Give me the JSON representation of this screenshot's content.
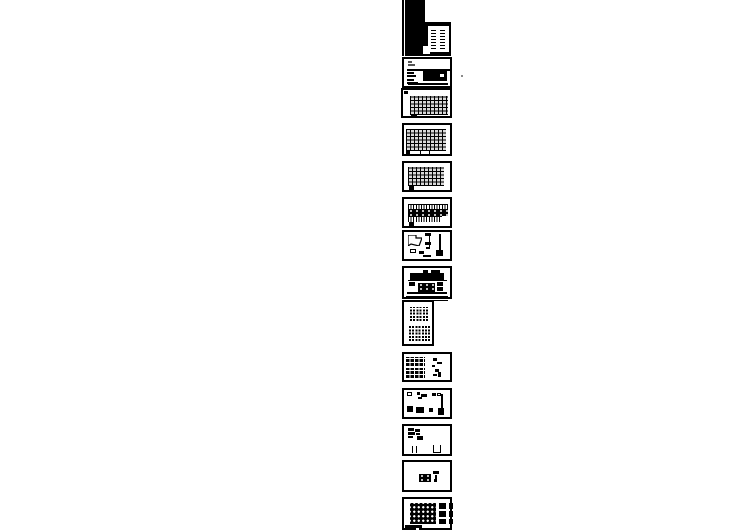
{
  "canvas": {
    "width": 749,
    "height": 530,
    "background": "#ffffff"
  },
  "document": {
    "kind": "cad-sheet-preview-strip",
    "sheet_count": 14
  },
  "colors": {
    "paper": "#ffffff",
    "ink": "#000000",
    "muted_mark": "#555555",
    "stray_dot": "#8a8a8a"
  },
  "sheets": [
    {
      "name": "sheet-01-cover",
      "x": 402,
      "y": 0,
      "w": 50,
      "h": 56,
      "frameless": true,
      "shapes": [
        {
          "t": "fill",
          "n": "left-edge-line",
          "x": 0,
          "y": 0,
          "w": 1.5,
          "h": 56
        },
        {
          "t": "fill",
          "n": "cover-black-mass",
          "x": 3,
          "y": 0,
          "w": 20,
          "h": 56
        },
        {
          "t": "fill",
          "n": "cover-body",
          "x": 3,
          "y": 22,
          "w": 46,
          "h": 34
        },
        {
          "t": "white",
          "n": "cover-panel",
          "x": 26,
          "y": 26,
          "w": 21,
          "h": 26
        },
        {
          "t": "white",
          "n": "cover-panel-step",
          "x": 21,
          "y": 46,
          "w": 7,
          "h": 8
        },
        {
          "t": "dashcol",
          "n": "drawing-list-column",
          "x": 29,
          "y": 28,
          "w": 5,
          "h": 21
        },
        {
          "t": "dashcol",
          "n": "drawing-list-column",
          "x": 38,
          "y": 28,
          "w": 5,
          "h": 21
        }
      ]
    },
    {
      "name": "sheet-02-notes",
      "x": 402,
      "y": 57,
      "w": 50,
      "h": 31,
      "shapes": [
        {
          "t": "gray",
          "n": "title-mark",
          "x": 4,
          "y": 2,
          "w": 4,
          "h": 2
        },
        {
          "t": "gray",
          "n": "title-mark",
          "x": 4,
          "y": 4.5,
          "w": 7,
          "h": 2
        },
        {
          "t": "hline",
          "n": "divider-line",
          "x": 3,
          "y": 10,
          "w": 44,
          "h": 1.5
        },
        {
          "t": "fill",
          "n": "text-bar",
          "x": 3,
          "y": 12.5,
          "w": 7,
          "h": 2
        },
        {
          "t": "fill",
          "n": "text-bar",
          "x": 3,
          "y": 16,
          "w": 9,
          "h": 2
        },
        {
          "t": "fill",
          "n": "text-bar",
          "x": 3,
          "y": 19.5,
          "w": 7,
          "h": 2
        },
        {
          "t": "fill",
          "n": "text-bar",
          "x": 3,
          "y": 22.5,
          "w": 11,
          "h": 2
        },
        {
          "t": "fill",
          "n": "table-block",
          "x": 19,
          "y": 12,
          "w": 24,
          "h": 10
        },
        {
          "t": "white",
          "n": "table-gap",
          "x": 36,
          "y": 15,
          "w": 4,
          "h": 3
        },
        {
          "t": "fill",
          "n": "bottom-bar",
          "x": 4,
          "y": 24,
          "w": 40,
          "h": 2
        }
      ]
    },
    {
      "name": "sheet-03-framing-plan",
      "x": 401,
      "y": 88,
      "w": 51,
      "h": 30,
      "shapes": [
        {
          "t": "fill",
          "n": "corner-mark",
          "x": 1,
          "y": 1,
          "w": 4,
          "h": 3
        },
        {
          "t": "hatch",
          "n": "framing-grid",
          "x": 7,
          "y": 6,
          "w": 38,
          "h": 19
        },
        {
          "t": "fill",
          "n": "tab-mark",
          "x": 8,
          "y": 25,
          "w": 6,
          "h": 3
        }
      ]
    },
    {
      "name": "sheet-04-framing-plan",
      "x": 402,
      "y": 123,
      "w": 50,
      "h": 33,
      "shapes": [
        {
          "t": "hatch",
          "n": "framing-grid",
          "x": 2,
          "y": 4,
          "w": 40,
          "h": 22
        },
        {
          "t": "outline",
          "n": "note-box",
          "x": 16,
          "y": 25,
          "w": 10,
          "h": 5
        },
        {
          "t": "fill",
          "n": "tab-mark",
          "x": 2,
          "y": 25,
          "w": 4,
          "h": 4
        }
      ]
    },
    {
      "name": "sheet-05-framing-plan",
      "x": 402,
      "y": 161,
      "w": 50,
      "h": 31,
      "shapes": [
        {
          "t": "hatch",
          "n": "framing-grid",
          "x": 4,
          "y": 4,
          "w": 36,
          "h": 19
        },
        {
          "t": "fill",
          "n": "tab-mark",
          "x": 5,
          "y": 23,
          "w": 5,
          "h": 4
        }
      ]
    },
    {
      "name": "sheet-06-framing-plan",
      "x": 402,
      "y": 197,
      "w": 50,
      "h": 31,
      "shapes": [
        {
          "t": "vticks",
          "n": "tick-row",
          "x": 4,
          "y": 5,
          "w": 40,
          "h": 5
        },
        {
          "t": "band",
          "n": "dense-band",
          "x": 4,
          "y": 10,
          "w": 40,
          "h": 7
        },
        {
          "t": "vticks",
          "n": "tick-row",
          "x": 4,
          "y": 17,
          "w": 34,
          "h": 5
        },
        {
          "t": "fill",
          "n": "tab-mark",
          "x": 5,
          "y": 23,
          "w": 5,
          "h": 4
        }
      ]
    },
    {
      "name": "sheet-07-details",
      "x": 402,
      "y": 230,
      "w": 50,
      "h": 31,
      "shapes": [
        {
          "t": "poly",
          "n": "detail-outline",
          "x": 4,
          "y": 3,
          "w": 14,
          "h": 11,
          "pts": "0,0 8,0 8,3 14,3 11,11 3,9 0,11"
        },
        {
          "t": "fill",
          "n": "detail-mark",
          "x": 21,
          "y": 1,
          "w": 6,
          "h": 3
        },
        {
          "t": "vline",
          "n": "detail-line",
          "x": 25,
          "y": 4,
          "w": 1.2,
          "h": 12
        },
        {
          "t": "fill",
          "n": "detail-mark",
          "x": 21,
          "y": 10,
          "w": 6,
          "h": 3
        },
        {
          "t": "fill",
          "n": "detail-mark",
          "x": 22,
          "y": 15,
          "w": 4,
          "h": 2
        },
        {
          "t": "vline",
          "n": "detail-line",
          "x": 35,
          "y": 2,
          "w": 1.5,
          "h": 22
        },
        {
          "t": "fill",
          "n": "detail-blob",
          "x": 32,
          "y": 18,
          "w": 7,
          "h": 6
        },
        {
          "t": "outline",
          "n": "small-box",
          "x": 6,
          "y": 17,
          "w": 6,
          "h": 4
        },
        {
          "t": "fill",
          "n": "detail-mark",
          "x": 15,
          "y": 19,
          "w": 5,
          "h": 3
        },
        {
          "t": "fill",
          "n": "detail-mark",
          "x": 19,
          "y": 23,
          "w": 8,
          "h": 2
        }
      ]
    },
    {
      "name": "sheet-08-details",
      "x": 402,
      "y": 266,
      "w": 50,
      "h": 33,
      "shapes": [
        {
          "t": "fill",
          "n": "top-mark",
          "x": 19,
          "y": 2,
          "w": 5,
          "h": 3
        },
        {
          "t": "fill",
          "n": "top-mark",
          "x": 27,
          "y": 2,
          "w": 9,
          "h": 3
        },
        {
          "t": "fill",
          "n": "dark-strip",
          "x": 6,
          "y": 5,
          "w": 34,
          "h": 7
        },
        {
          "t": "hline",
          "n": "baseline",
          "x": 4,
          "y": 12,
          "w": 39,
          "h": 1.2
        },
        {
          "t": "fill",
          "n": "block",
          "x": 5,
          "y": 14,
          "w": 6,
          "h": 4
        },
        {
          "t": "band",
          "n": "dotted-strip",
          "x": 14,
          "y": 15,
          "w": 17,
          "h": 9
        },
        {
          "t": "fill",
          "n": "block",
          "x": 33,
          "y": 14,
          "w": 6,
          "h": 4
        },
        {
          "t": "fill",
          "n": "block",
          "x": 33,
          "y": 19,
          "w": 6,
          "h": 4
        },
        {
          "t": "hline",
          "n": "baseline",
          "x": 3,
          "y": 24,
          "w": 40,
          "h": 1.5
        },
        {
          "t": "hline",
          "n": "footer-line",
          "x": 2,
          "y": 27.5,
          "w": 42,
          "h": 2
        }
      ]
    },
    {
      "name": "sheet-09-elevations-portrait",
      "x": 402,
      "y": 300,
      "w": 32,
      "h": 46,
      "shapes": [
        {
          "t": "windows",
          "n": "building-elevation",
          "x": 6,
          "y": 5,
          "w": 18,
          "h": 14
        },
        {
          "t": "windows",
          "n": "building-elevation",
          "x": 5,
          "y": 23,
          "w": 21,
          "h": 16
        }
      ]
    },
    {
      "name": "sheet-10-tables",
      "x": 402,
      "y": 352,
      "w": 50,
      "h": 30,
      "shapes": [
        {
          "t": "table",
          "n": "schedule-table",
          "x": 2,
          "y": 3,
          "w": 19,
          "h": 9
        },
        {
          "t": "table",
          "n": "schedule-table",
          "x": 2,
          "y": 14,
          "w": 19,
          "h": 10
        },
        {
          "t": "fill",
          "n": "detail-mark",
          "x": 29,
          "y": 4,
          "w": 4,
          "h": 3
        },
        {
          "t": "fill",
          "n": "detail-mark",
          "x": 33,
          "y": 8,
          "w": 5,
          "h": 2
        },
        {
          "t": "fill",
          "n": "detail-mark",
          "x": 28,
          "y": 11,
          "w": 3,
          "h": 2
        },
        {
          "t": "fill",
          "n": "detail-mark",
          "x": 31,
          "y": 15,
          "w": 4,
          "h": 3
        },
        {
          "t": "fill",
          "n": "detail-mark",
          "x": 34,
          "y": 18,
          "w": 3,
          "h": 5
        },
        {
          "t": "fill",
          "n": "detail-mark",
          "x": 29,
          "y": 20,
          "w": 4,
          "h": 2
        }
      ]
    },
    {
      "name": "sheet-11-details",
      "x": 402,
      "y": 388,
      "w": 50,
      "h": 31,
      "shapes": [
        {
          "t": "outline",
          "n": "small-box",
          "x": 3,
          "y": 2,
          "w": 5,
          "h": 4
        },
        {
          "t": "fill",
          "n": "detail-mark",
          "x": 13,
          "y": 2,
          "w": 3,
          "h": 3
        },
        {
          "t": "fill",
          "n": "detail-mark",
          "x": 17,
          "y": 4,
          "w": 6,
          "h": 3
        },
        {
          "t": "fill",
          "n": "detail-mark",
          "x": 14,
          "y": 7,
          "w": 4,
          "h": 2
        },
        {
          "t": "fill",
          "n": "detail-mark",
          "x": 28,
          "y": 3,
          "w": 4,
          "h": 3
        },
        {
          "t": "outline",
          "n": "small-box",
          "x": 33,
          "y": 2.5,
          "w": 4,
          "h": 3.5
        },
        {
          "t": "vline",
          "n": "column-line",
          "x": 37,
          "y": 4,
          "w": 1.5,
          "h": 20
        },
        {
          "t": "fill",
          "n": "detail-blob",
          "x": 34,
          "y": 18,
          "w": 6,
          "h": 7
        },
        {
          "t": "fill",
          "n": "black-square",
          "x": 3,
          "y": 16,
          "w": 6,
          "h": 6
        },
        {
          "t": "fill",
          "n": "detail-mark",
          "x": 12,
          "y": 17,
          "w": 8,
          "h": 6
        },
        {
          "t": "fill",
          "n": "detail-mark",
          "x": 25,
          "y": 18,
          "w": 4,
          "h": 4
        }
      ]
    },
    {
      "name": "sheet-12-details",
      "x": 402,
      "y": 424,
      "w": 50,
      "h": 32,
      "shapes": [
        {
          "t": "fill",
          "n": "list-mark",
          "x": 4,
          "y": 2,
          "w": 6,
          "h": 3
        },
        {
          "t": "fill",
          "n": "list-mark",
          "x": 11,
          "y": 3,
          "w": 5,
          "h": 3
        },
        {
          "t": "fill",
          "n": "list-mark",
          "x": 4,
          "y": 6,
          "w": 7,
          "h": 3
        },
        {
          "t": "fill",
          "n": "list-mark",
          "x": 12,
          "y": 7,
          "w": 4,
          "h": 2
        },
        {
          "t": "fill",
          "n": "list-mark",
          "x": 4,
          "y": 10,
          "w": 5,
          "h": 2
        },
        {
          "t": "fill",
          "n": "list-mark",
          "x": 13,
          "y": 9.5,
          "w": 6,
          "h": 4
        },
        {
          "t": "vline",
          "n": "column-line",
          "x": 8,
          "y": 20,
          "w": 1.2,
          "h": 7
        },
        {
          "t": "vline",
          "n": "column-line",
          "x": 12,
          "y": 20,
          "w": 1.2,
          "h": 7
        },
        {
          "t": "ubox",
          "n": "u-channel-detail",
          "x": 29,
          "y": 19,
          "w": 8,
          "h": 8
        }
      ]
    },
    {
      "name": "sheet-13-details",
      "x": 402,
      "y": 460,
      "w": 50,
      "h": 32,
      "shapes": [
        {
          "t": "band",
          "n": "detail-blob",
          "x": 15,
          "y": 12,
          "w": 12,
          "h": 8
        },
        {
          "t": "fill",
          "n": "t-mark",
          "x": 29,
          "y": 9,
          "w": 6,
          "h": 3
        },
        {
          "t": "vline",
          "n": "tick",
          "x": 31,
          "y": 12.5,
          "w": 2,
          "h": 4
        },
        {
          "t": "fill",
          "n": "detail-mark",
          "x": 30,
          "y": 17,
          "w": 3,
          "h": 2.5
        }
      ]
    },
    {
      "name": "sheet-14-pile-layout",
      "x": 402,
      "y": 497,
      "w": 50,
      "h": 33,
      "shapes": [
        {
          "t": "dots",
          "n": "pile-grid",
          "x": 6,
          "y": 4,
          "w": 26,
          "h": 21
        },
        {
          "t": "fill",
          "n": "legend-block",
          "x": 35,
          "y": 4,
          "w": 7,
          "h": 6
        },
        {
          "t": "fill",
          "n": "legend-block",
          "x": 45,
          "y": 4,
          "w": 4,
          "h": 6
        },
        {
          "t": "fill",
          "n": "legend-block",
          "x": 35,
          "y": 12,
          "w": 7,
          "h": 6
        },
        {
          "t": "fill",
          "n": "legend-block",
          "x": 45,
          "y": 12,
          "w": 4,
          "h": 6
        },
        {
          "t": "fill",
          "n": "legend-block",
          "x": 35,
          "y": 20,
          "w": 7,
          "h": 5
        },
        {
          "t": "fill",
          "n": "legend-block",
          "x": 45,
          "y": 20,
          "w": 4,
          "h": 5
        },
        {
          "t": "fill",
          "n": "corner-bar",
          "x": 1,
          "y": 26,
          "w": 17,
          "h": 6
        },
        {
          "t": "white",
          "n": "corner-notch",
          "x": 12,
          "y": 29,
          "w": 3,
          "h": 2
        }
      ]
    }
  ],
  "extras": [
    {
      "t": "hline",
      "n": "top-extension-line",
      "x": 434,
      "y": 299.5,
      "w": 14,
      "h": 1.2
    },
    {
      "t": "speck",
      "n": "stray-dot",
      "x": 461,
      "y": 75,
      "w": 2,
      "h": 2
    }
  ]
}
